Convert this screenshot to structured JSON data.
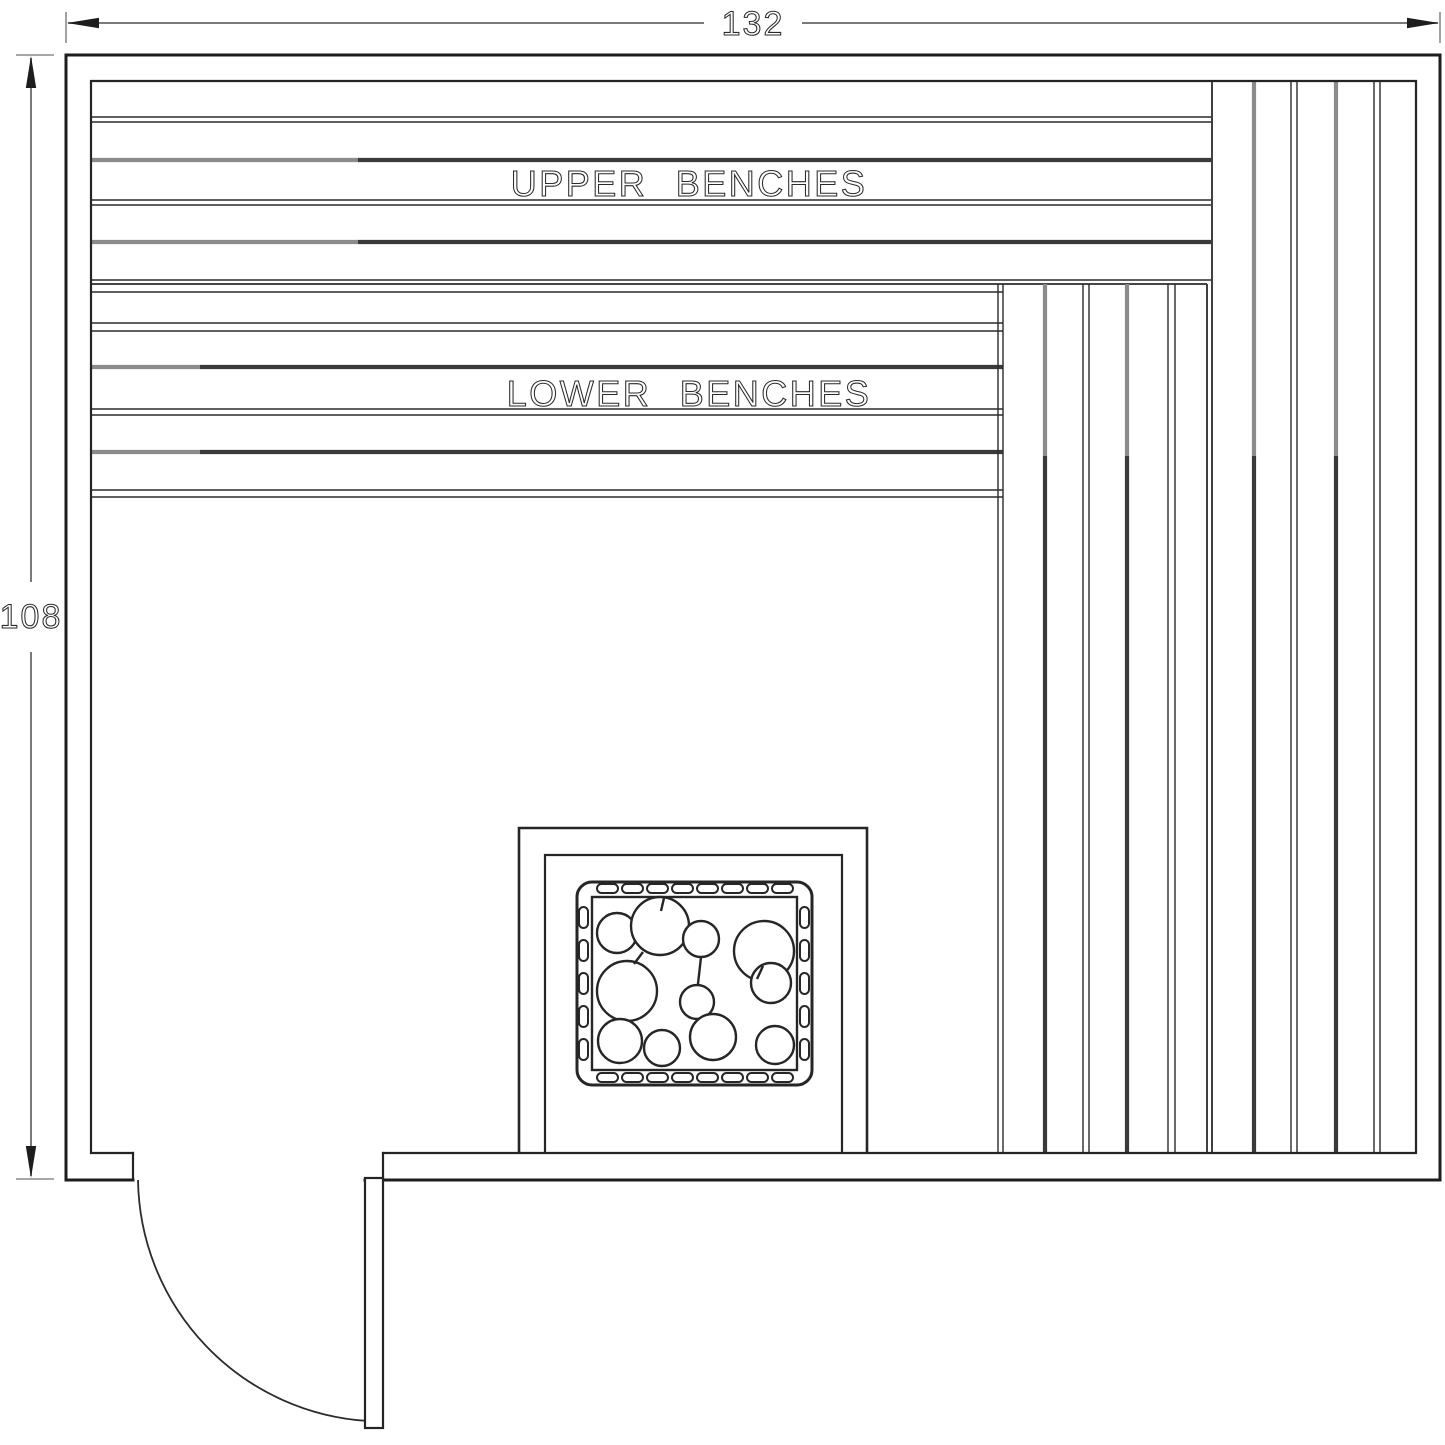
{
  "drawing": {
    "kind": "sauna-room-floor-plan",
    "dimensions": {
      "width": "132",
      "height": "108"
    },
    "labels": {
      "upper_benches": "UPPER BENCHES",
      "lower_benches": "LOWER BENCHES"
    },
    "colors": {
      "background": "#ffffff",
      "line_dark": "#242424",
      "line_gray": "#8b8b8b",
      "dimension_gray": "#7a7a7a"
    }
  }
}
